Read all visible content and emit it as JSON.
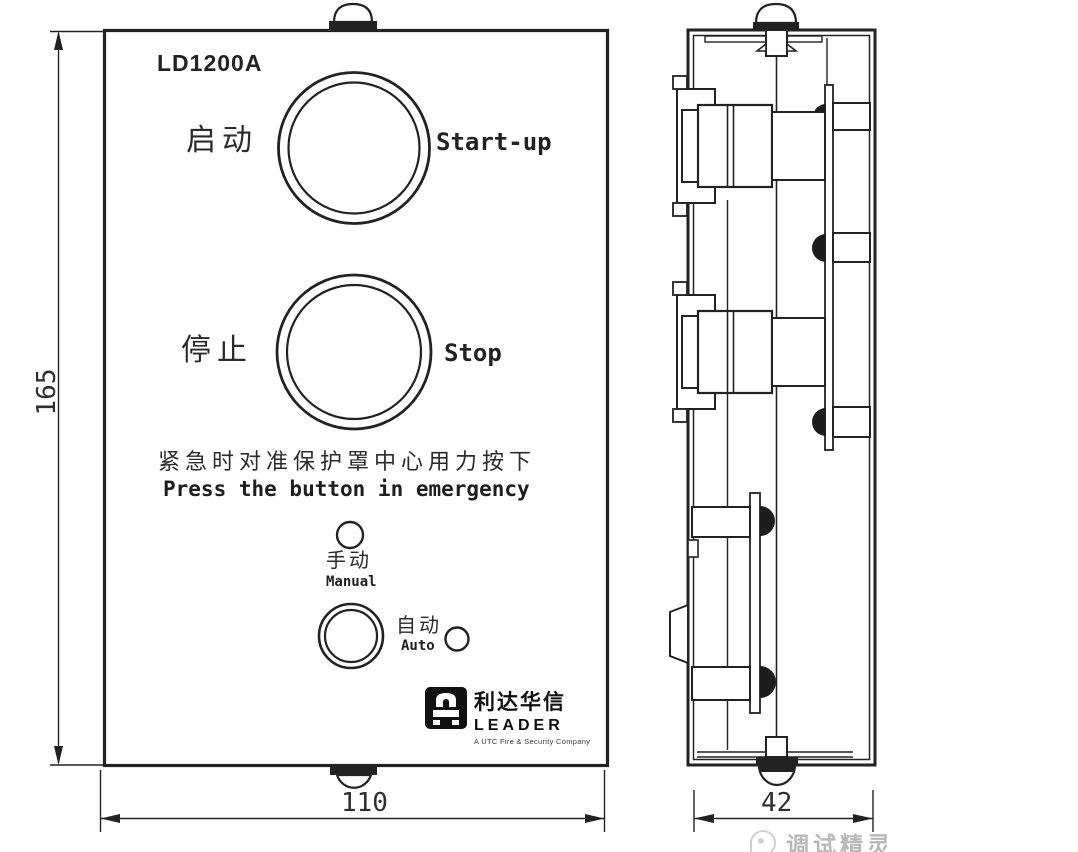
{
  "model": "LD1200A",
  "front_view": {
    "buttons": [
      {
        "cn": "启动",
        "en": "Start-up"
      },
      {
        "cn": "停止",
        "en": "Stop"
      }
    ],
    "emergency_note_cn": "紧急时对准保护罩中心用力按下",
    "emergency_note_en": "Press the button in emergency",
    "modes": [
      {
        "cn": "手动",
        "en": "Manual"
      },
      {
        "cn": "自动",
        "en": "Auto"
      }
    ],
    "logo": {
      "brand_cn": "利达华信",
      "brand_en": "LEADER",
      "tagline": "A UTC Fire & Security Company"
    }
  },
  "dimensions": {
    "height_mm": "165",
    "width_mm": "110",
    "depth_mm": "42"
  },
  "watermark": "调试精灵",
  "colors": {
    "line": "#222222",
    "background": "#ffffff",
    "watermark": "#b8b8b8",
    "logo_black": "#101010"
  }
}
